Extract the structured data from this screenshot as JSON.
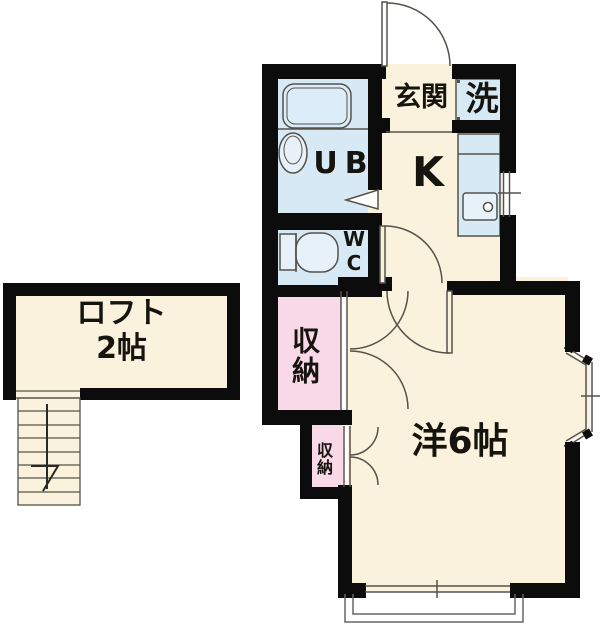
{
  "rooms": {
    "entrance": {
      "label": "玄関"
    },
    "laundry": {
      "label": "洗"
    },
    "unit_bath": {
      "label": "UB"
    },
    "toilet": {
      "label": "WC"
    },
    "kitchen": {
      "label": "K"
    },
    "closet_large": {
      "label": "収納"
    },
    "closet_small": {
      "label": "収納"
    },
    "western_room": {
      "label": "洋6帖"
    },
    "loft": {
      "label": "ロフト",
      "size": "2帖"
    }
  },
  "colors": {
    "background": "#ffffff",
    "floor": "#faf2dd",
    "wet_area": "#d7e9f5",
    "fixture_fill": "#e6f1f9",
    "closet": "#f9d9e7",
    "wall": "#0c0c0c",
    "line": "#55524a",
    "balcony_line": "#666666",
    "text": "#15140f"
  }
}
